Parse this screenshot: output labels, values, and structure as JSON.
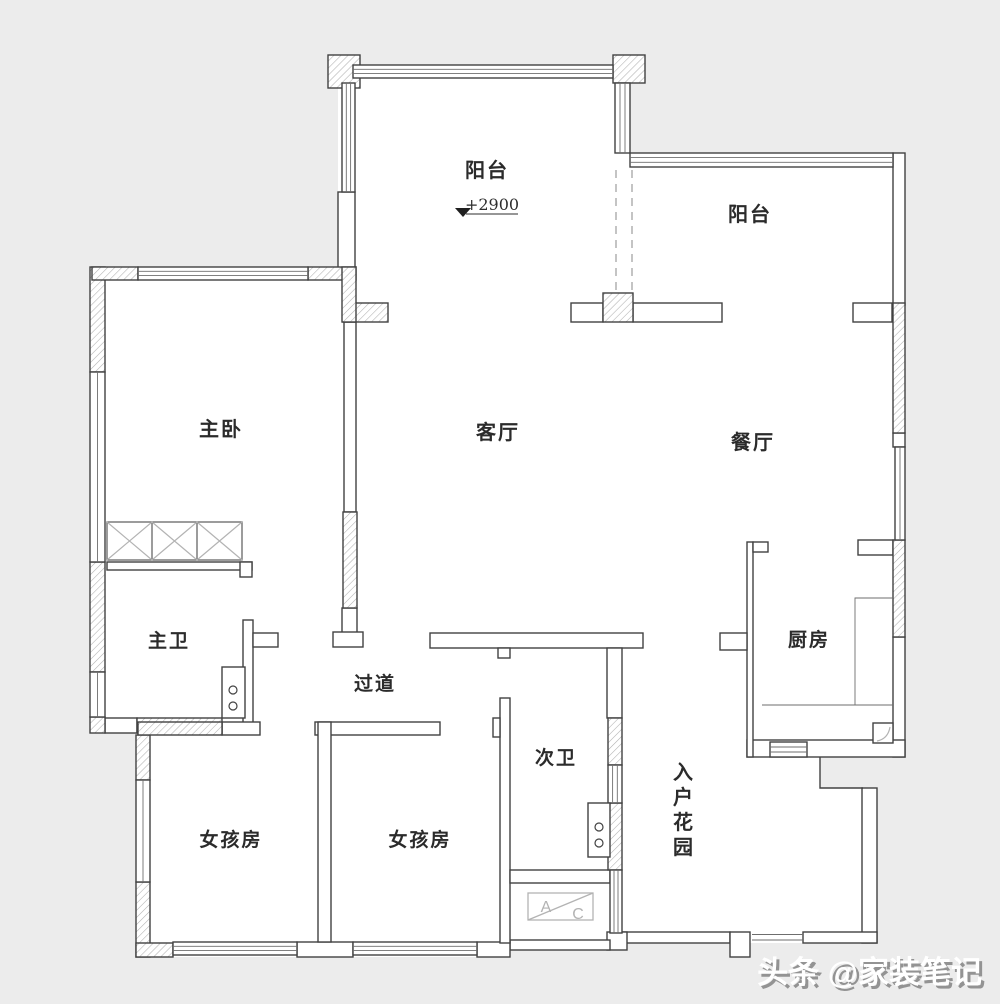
{
  "plan": {
    "rooms": {
      "balcony_top": "阳台",
      "balcony_right": "阳台",
      "master_bedroom": "主卧",
      "living_room": "客厅",
      "dining_room": "餐厅",
      "master_bath": "主卫",
      "corridor": "过道",
      "kitchen": "厨房",
      "second_bath": "次卫",
      "girl_room_1": "女孩房",
      "girl_room_2": "女孩房",
      "entry_garden_chars": [
        "入",
        "户",
        "花",
        "园"
      ]
    },
    "annotations": {
      "elevation": "+2900",
      "ac_letter_a": "A",
      "ac_letter_c": "C"
    },
    "watermark": "头条 @家装笔记",
    "colors": {
      "background": "#ececec",
      "paper": "#ffffff",
      "wall_line": "#424242",
      "hatch": "#b0b0b0",
      "dashed_line": "#9c9c9c",
      "label_text": "#2b2b2b",
      "ac_box": "#b3b3b3",
      "watermark_text": "#ffffff",
      "watermark_shadow": "#8f8f8f"
    }
  }
}
